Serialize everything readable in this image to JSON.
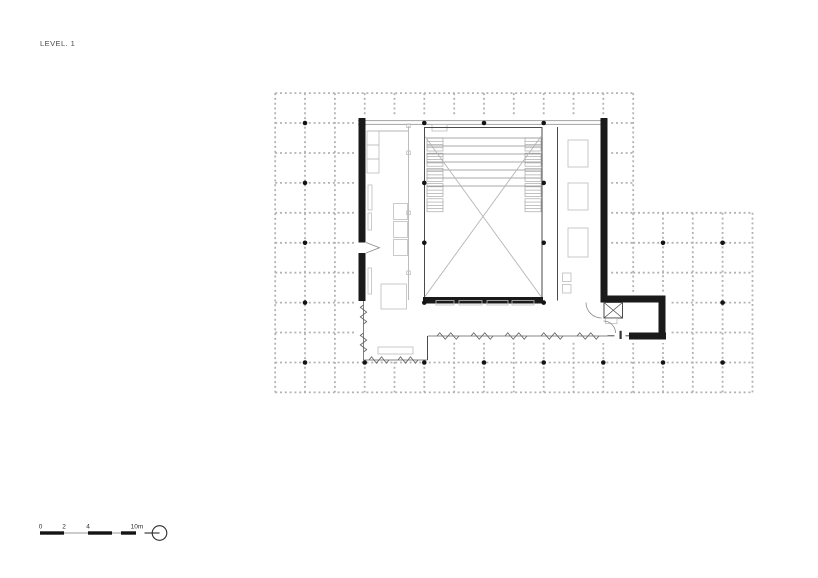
{
  "sheet": {
    "title": "LEVEL. 1",
    "background": "#ffffff"
  },
  "plan": {
    "colors": {
      "grid": "#b3b3b3",
      "column_dot": "#141414",
      "wall": "#1a1a1a",
      "light_line": "#b5b5b5",
      "diagonal": "#b5b5b5"
    }
  },
  "scale_bar": {
    "labels": [
      "0",
      "2",
      "4",
      "10m"
    ]
  }
}
